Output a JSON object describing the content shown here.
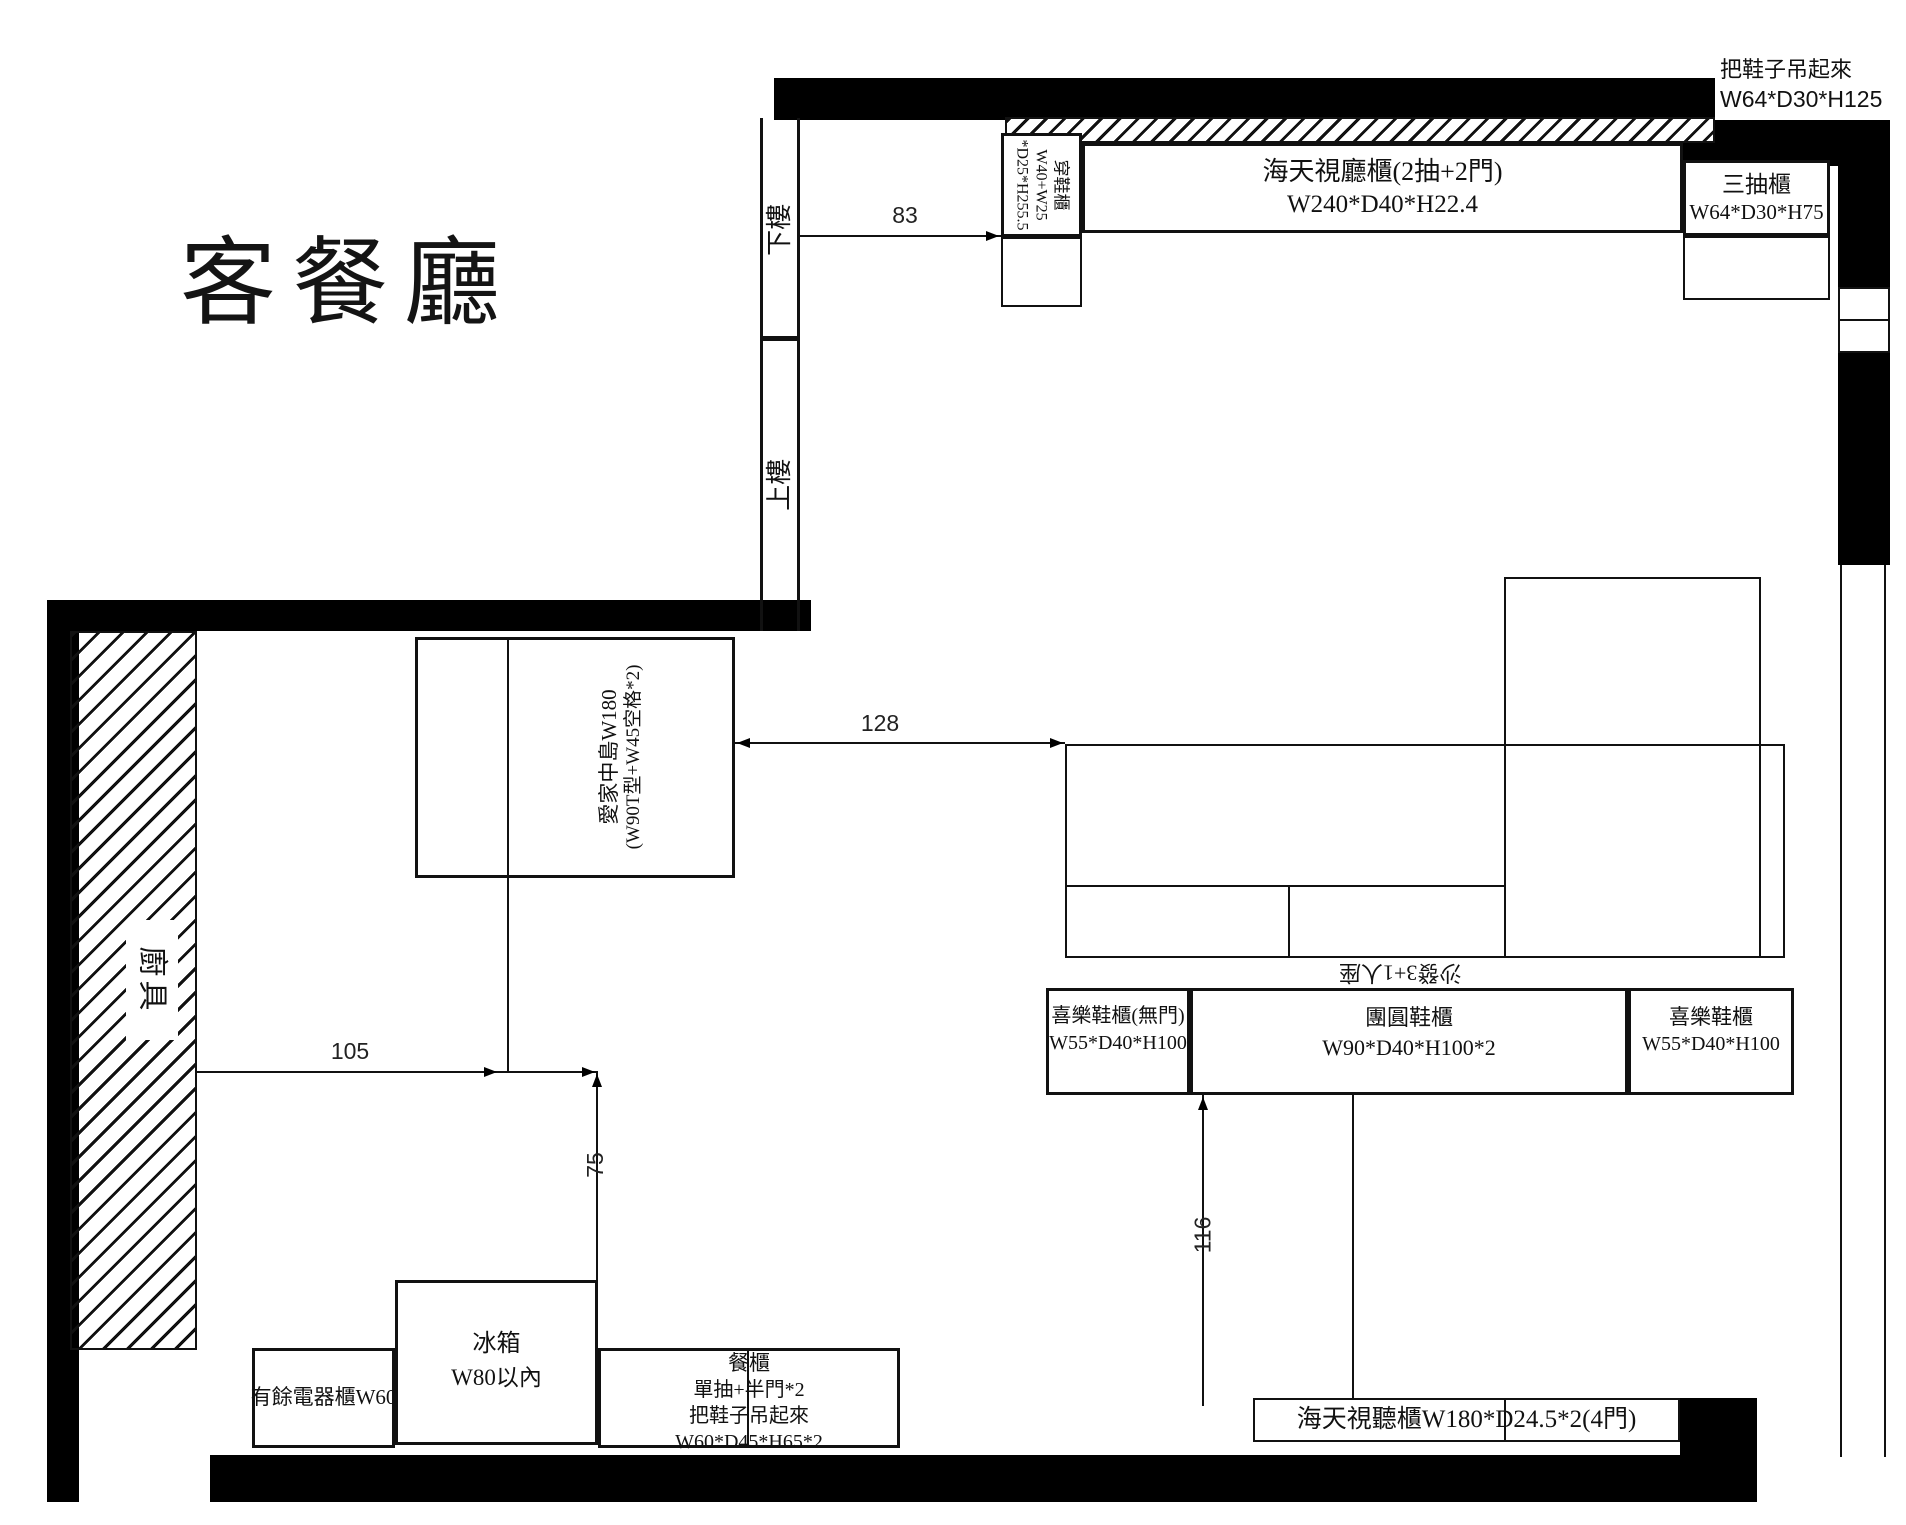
{
  "title": "客餐廳",
  "note_tr": {
    "l1": "把鞋子吊起來",
    "l2": "W64*D30*H125"
  },
  "stairs": {
    "down": "下樓",
    "up": "上樓"
  },
  "dims": {
    "d83": "83",
    "d128": "128",
    "d105": "105",
    "d75": "75",
    "d116": "116"
  },
  "entry": {
    "name": "穿鞋櫃",
    "spec1": "W40+W25",
    "spec2": "*D25*H255.5"
  },
  "toptv": {
    "name": "海天視廳櫃(2抽+2門)",
    "spec": "W240*D40*H22.4"
  },
  "drawer3": {
    "name": "三抽櫃",
    "spec": "W64*D30*H75"
  },
  "island": {
    "l1": "愛家中島W180",
    "l2": "(W90T型+W45空格*2)"
  },
  "kitchen": {
    "label": "廚具"
  },
  "sofa": {
    "label": "沙發3+1人座"
  },
  "shoe1": {
    "name": "喜樂鞋櫃(無門)",
    "spec": "W55*D40*H100"
  },
  "shoe2": {
    "name": "團圓鞋櫃",
    "spec": "W90*D40*H100*2"
  },
  "shoe3": {
    "name": "喜樂鞋櫃",
    "spec": "W55*D40*H100"
  },
  "appliance": {
    "name": "有餘電器櫃W60"
  },
  "fridge": {
    "name": "冰箱",
    "spec": "W80以內"
  },
  "buffet": {
    "l1": "餐櫃",
    "l2": "單抽+半門*2",
    "l3": "把鞋子吊起來",
    "l4": "W60*D45*H65*2"
  },
  "bottomtv": {
    "name": "海天視聽櫃W180*D24.5*2(4門)"
  },
  "colors": {
    "wall": "#000000",
    "line": "#111111"
  }
}
